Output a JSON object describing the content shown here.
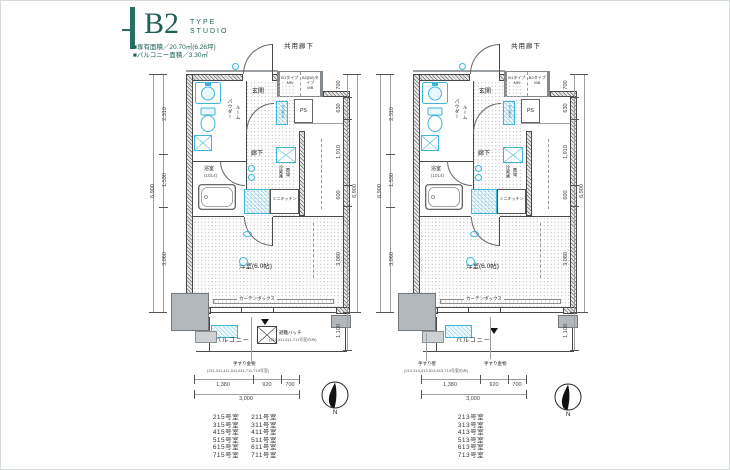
{
  "header": {
    "type_code": "B2",
    "type_word1": "TYPE",
    "type_word2": "STUDIO",
    "area_line1": "■専有面積／20.70㎡(6.26坪)",
    "area_line2": "■バルコニー面積／3.30㎡"
  },
  "labels": {
    "common_corridor": "共用廊下",
    "entrance": "玄関",
    "powder_line1": "パウダー",
    "powder_line2": "ルーム",
    "shoe_box": "下足入",
    "ps": "PS",
    "hallway": "廊下",
    "bathroom": "浴室",
    "bathroom_size": "(1014)",
    "fridge_line1": "冷蔵庫",
    "fridge_line2": "置場",
    "kitchen": "ミニキッチン",
    "main_room": "洋室(6.0帖)",
    "curtain_box": "カーテンボックス",
    "balcony": "バルコニー",
    "evac_hatch": "避難ハッチ",
    "evac_hatch_note": "(211,411,611,711号室のみ)",
    "handrail_metal": "手すり金物",
    "handrail_wall": "手すり壁",
    "compass_n": "N"
  },
  "dims": {
    "v_left_1": "2,310",
    "v_left_2": "1,530",
    "v_left_3": "3,060",
    "v_right_1": "700",
    "v_right_2": "630",
    "v_right_3": "1,910",
    "v_right_4": "600",
    "v_right_5": "3,080",
    "v_balcony": "1,100",
    "v_total": "6,900",
    "h_1": "1,380",
    "h_2": "920",
    "h_3": "700",
    "h_total": "3,000"
  },
  "plans": [
    {
      "mb1_line1": "B1タイプ",
      "mb1_line2": "MB",
      "mb2_line1": "B2(B0)タイプ",
      "mb2_line2": "MB",
      "note_rooms": "(211,311,411,511,611,711,715号室)",
      "rooms": [
        "215号室",
        "211号室",
        "315号室",
        "311号室",
        "415号室",
        "411号室",
        "515号室",
        "511号室",
        "615号室",
        "611号室",
        "715号室",
        "711号室"
      ]
    },
    {
      "mb1_line1": "B1タイプ",
      "mb1_line2": "MB",
      "mb2_line1": "B2タイプ",
      "mb2_line2": "MB",
      "note_rooms": "(213,313,413,513,613,713号室のみ)",
      "rooms": [
        "213号室",
        "313号室",
        "413号室",
        "513号室",
        "613号室",
        "713号室"
      ]
    }
  ]
}
